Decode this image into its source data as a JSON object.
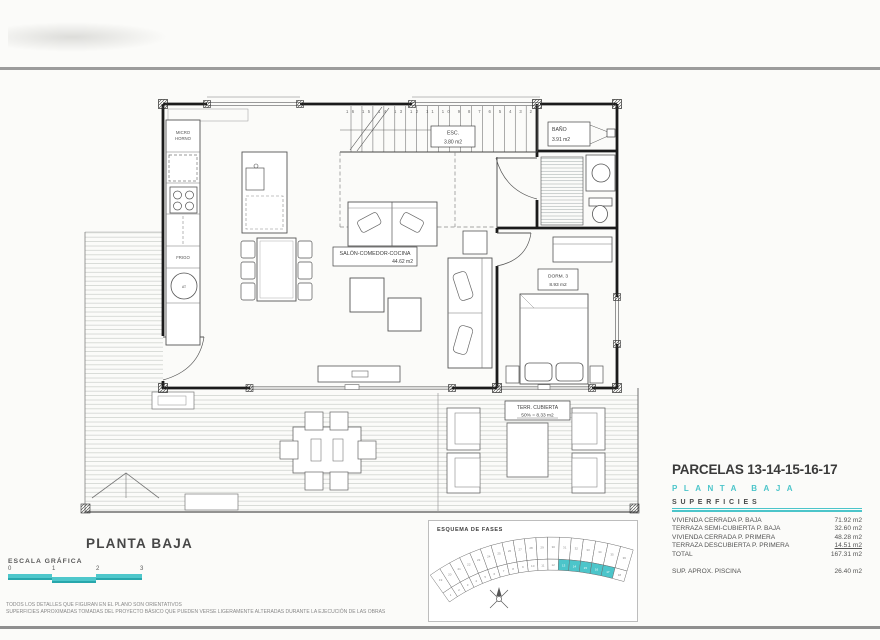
{
  "colors": {
    "accent": "#4cc5ca",
    "rule_gray": "#9c9c9c",
    "ink": "#3a3a3a"
  },
  "plan": {
    "rooms": {
      "salon": {
        "name": "SALÓN-COMEDOR-COCINA",
        "area": "44.62 m2"
      },
      "dorm3": {
        "name": "DORM. 3",
        "area": "8.93 m2"
      },
      "bano": {
        "name": "BAÑO",
        "area": "3.91 m2"
      },
      "terraza": {
        "name": "TERR. CUBIERTA",
        "area": "50% = 8.33 m2"
      }
    },
    "stairs": {
      "label": "ESC.",
      "area": "3.80 m2",
      "numbers": "16 15 14 13 12 11 10 9 8 7 6 5 4 3 2"
    },
    "kitchen": {
      "micro_line1": "MICRO",
      "micro_line2": "HORNO",
      "frigo": "FRIGO",
      "at": "AT"
    }
  },
  "info": {
    "title": "PARCELAS 13-14-15-16-17",
    "subtitle": "PLANTA BAJA",
    "section": "SUPERFICIES",
    "rows": [
      {
        "label": "VIVIENDA CERRADA P. BAJA",
        "value": "71.92 m2"
      },
      {
        "label": "TERRAZA SEMI-CUBIERTA P. BAJA",
        "value": "32.60 m2"
      },
      {
        "label": "VIVIENDA CERRADA P. PRIMERA",
        "value": "48.28 m2"
      },
      {
        "label": "TERRAZA DESCUBIERTA P. PRIMERA",
        "value": "14.51 m2"
      }
    ],
    "total": {
      "label": "TOTAL",
      "value": "167.31 m2"
    },
    "pool": {
      "label": "SUP.  APROX.  PISCINA",
      "value": "26.40 m2"
    }
  },
  "footer": {
    "plan_title": "PLANTA BAJA",
    "scale_label": "ESCALA GRÁFICA",
    "scale_ticks": [
      "0",
      "1",
      "2",
      "3"
    ],
    "disclaimer1": "TODOS LOS DETALLES QUE FIGURAN EN EL PLANO SON ORIENTATIVOS",
    "disclaimer2": "SUPERFICIES APROXIMADAS TOMADAS DEL PROYECTO BÁSICO QUE PUEDEN VERSE LIGERAMENTE ALTERADAS DURANTE LA EJECUCIÓN DE LAS OBRAS"
  },
  "esquema": {
    "title": "ESQUEMA DE FASES",
    "cell_count": 18,
    "highlighted": [
      13,
      14,
      15,
      16,
      17
    ]
  }
}
